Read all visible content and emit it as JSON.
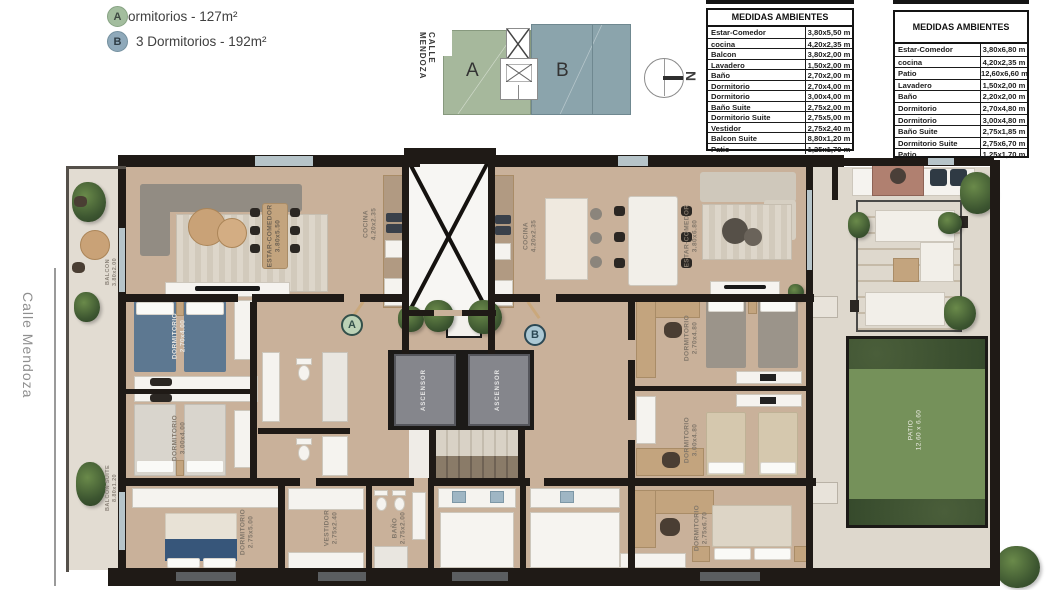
{
  "legend": {
    "items": [
      {
        "badge": "A",
        "label": "3 Dormitorios - 127m²"
      },
      {
        "badge": "B",
        "label": "3 Dormitorios - 192m²"
      }
    ]
  },
  "site_plan": {
    "street": "CALLE MENDOZA",
    "unit_a_label": "A",
    "unit_b_label": "B"
  },
  "compass": {
    "north_label": "N"
  },
  "street_label": "Calle Mendoza",
  "tables": [
    {
      "title": "MEDIDAS AMBIENTES",
      "rows": [
        [
          "Estar-Comedor",
          "3,80x5,50 m"
        ],
        [
          "cocina",
          "4,20x2,35 m"
        ],
        [
          "Balcon",
          "3,80x2,00 m"
        ],
        [
          "Lavadero",
          "1,50x2,00 m"
        ],
        [
          "Baño",
          "2,70x2,00 m"
        ],
        [
          "Dormitorio",
          "2,70x4,00 m"
        ],
        [
          "Dormitorio",
          "3,00x4,00 m"
        ],
        [
          "Baño Suite",
          "2,75x2,00 m"
        ],
        [
          "Dormitorio Suite",
          "2,75x5,00 m"
        ],
        [
          "Vestidor",
          "2,75x2,40 m"
        ],
        [
          "Balcon Suite",
          "8,80x1,20 m"
        ],
        [
          "Patio",
          "1,25x1,70 m"
        ]
      ]
    },
    {
      "title": "MEDIDAS AMBIENTES",
      "rows": [
        [
          "Estar-Comedor",
          "3,80x6,80 m"
        ],
        [
          "cocina",
          "4,20x2,35 m"
        ],
        [
          "Patio",
          "12,60x6,60 m"
        ],
        [
          "Lavadero",
          "1,50x2,00 m"
        ],
        [
          "Baño",
          "2,20x2,00 m"
        ],
        [
          "Dormitorio",
          "2,70x4,80 m"
        ],
        [
          "Dormitorio",
          "3,00x4,80 m"
        ],
        [
          "Baño Suite",
          "2,75x1,85 m"
        ],
        [
          "Dormitorio Suite",
          "2,75x6,70 m"
        ],
        [
          "Patio",
          "1,25x1,70 m"
        ]
      ]
    }
  ],
  "plan": {
    "entry_badges": {
      "a": "A",
      "b": "B"
    },
    "labels": {
      "balcon_a": "BALCON\n3.80x2.00",
      "balcon_suite": "BALCON SUITE\n8.80x1.20",
      "estar_a": "ESTAR-COMEDOR\n3.80x5.50",
      "cocina_a": "COCINA\n4.20x2.35",
      "dorm_a1": "DORMITORIO\n2.70x4.00",
      "dorm_a2": "DORMITORIO\n3.00x4.00",
      "dorm_suite_a": "DORMITORIO\n2.75x5.00",
      "vestidor": "VESTIDOR\n2.75x2.40",
      "banio_suite_a": "BAÑO\n2.75x2.00",
      "ascensor_1": "ASCENSOR",
      "ascensor_2": "ASCENSOR",
      "cocina_b": "COCINA\n4.20x2.35",
      "estar_b": "ESTAR-COMEDOR\n3.80x6.80",
      "dorm_b1": "DORMITORIO\n2.70x4.80",
      "dorm_b2": "DORMITORIO\n3.00x4.80",
      "dorm_suite_b": "DORMITORIO\n2.75x6.70",
      "patio": "PATIO\n12.60 x 6.60"
    }
  },
  "colors": {
    "legend_a_badge": "#a3bd9e",
    "legend_b_badge": "#8fa9ba",
    "site_unit_a": "#a6b89c",
    "site_unit_b": "#8ba4ac",
    "wall": "#1f1a16",
    "floor_wood": "#c9b19a",
    "patio_grass": "#75915a",
    "bed_blue": "#5d7891",
    "suite_bed_blue": "#37567a"
  }
}
